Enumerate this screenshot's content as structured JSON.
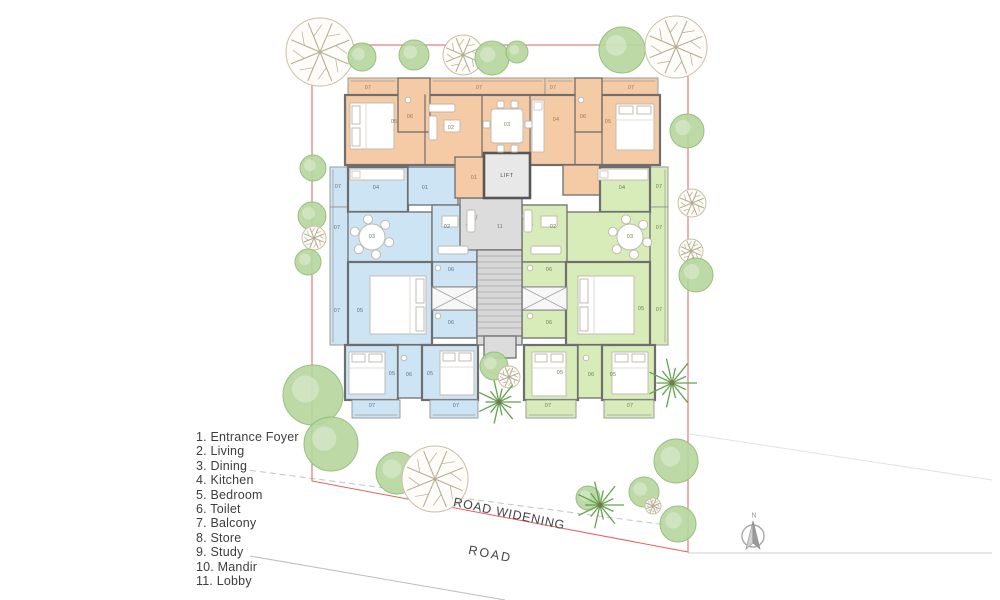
{
  "legend": {
    "items": [
      "1. Entrance Foyer",
      "2. Living",
      "3. Dining",
      "4. Kitchen",
      "5. Bedroom",
      "6. Toilet",
      "7. Balcony",
      "8. Store",
      "9. Study",
      "10. Mandir",
      "11. Lobby"
    ]
  },
  "annotations": {
    "road": "ROAD",
    "road_widening": "ROAD WIDENING",
    "lift": "LIFT",
    "north": "N"
  },
  "room_labels": {
    "orange": {
      "color": "#967a62",
      "items": [
        {
          "n": "07",
          "x": 368,
          "y": 88
        },
        {
          "n": "07",
          "x": 479,
          "y": 88
        },
        {
          "n": "07",
          "x": 553,
          "y": 88
        },
        {
          "n": "07",
          "x": 631,
          "y": 88
        },
        {
          "n": "06",
          "x": 410,
          "y": 117
        },
        {
          "n": "06",
          "x": 583,
          "y": 117
        },
        {
          "n": "05",
          "x": 394,
          "y": 122
        },
        {
          "n": "05",
          "x": 608,
          "y": 122
        },
        {
          "n": "02",
          "x": 451,
          "y": 128
        },
        {
          "n": "03",
          "x": 507,
          "y": 125
        },
        {
          "n": "04",
          "x": 556,
          "y": 120
        },
        {
          "n": "01",
          "x": 474,
          "y": 178
        }
      ]
    },
    "blue": {
      "color": "#5f7585",
      "items": [
        {
          "n": "07",
          "x": 338,
          "y": 187
        },
        {
          "n": "07",
          "x": 337,
          "y": 228
        },
        {
          "n": "07",
          "x": 337,
          "y": 311
        },
        {
          "n": "07",
          "x": 372,
          "y": 406
        },
        {
          "n": "07",
          "x": 456,
          "y": 406
        },
        {
          "n": "04",
          "x": 376,
          "y": 188
        },
        {
          "n": "01",
          "x": 425,
          "y": 188
        },
        {
          "n": "02",
          "x": 447,
          "y": 227
        },
        {
          "n": "03",
          "x": 372,
          "y": 237
        },
        {
          "n": "06",
          "x": 451,
          "y": 270
        },
        {
          "n": "06",
          "x": 451,
          "y": 323
        },
        {
          "n": "06",
          "x": 409,
          "y": 375
        },
        {
          "n": "05",
          "x": 360,
          "y": 311
        },
        {
          "n": "05",
          "x": 392,
          "y": 374
        },
        {
          "n": "05",
          "x": 430,
          "y": 374
        }
      ]
    },
    "green": {
      "color": "#6d7f55",
      "items": [
        {
          "n": "07",
          "x": 659,
          "y": 187
        },
        {
          "n": "07",
          "x": 659,
          "y": 228
        },
        {
          "n": "07",
          "x": 659,
          "y": 310
        },
        {
          "n": "07",
          "x": 548,
          "y": 406
        },
        {
          "n": "07",
          "x": 630,
          "y": 406
        },
        {
          "n": "04",
          "x": 622,
          "y": 188
        },
        {
          "n": "02",
          "x": 553,
          "y": 227
        },
        {
          "n": "03",
          "x": 630,
          "y": 237
        },
        {
          "n": "06",
          "x": 549,
          "y": 270
        },
        {
          "n": "06",
          "x": 549,
          "y": 323
        },
        {
          "n": "06",
          "x": 591,
          "y": 375
        },
        {
          "n": "05",
          "x": 641,
          "y": 309
        },
        {
          "n": "05",
          "x": 560,
          "y": 373
        },
        {
          "n": "05",
          "x": 613,
          "y": 375
        }
      ]
    },
    "core": {
      "color": "#7a7a7a",
      "items": [
        {
          "n": "11",
          "x": 500,
          "y": 227
        }
      ]
    }
  },
  "colors": {
    "unit_orange": "#f5cba6",
    "unit_blue": "#cde4f4",
    "unit_green": "#d8ecba",
    "core_gray": "#dcdcdc",
    "wall": "#6e6e6e",
    "boundary_red": "#e06262",
    "tree_green": "#b7d7a0",
    "road_text": "#454545"
  }
}
